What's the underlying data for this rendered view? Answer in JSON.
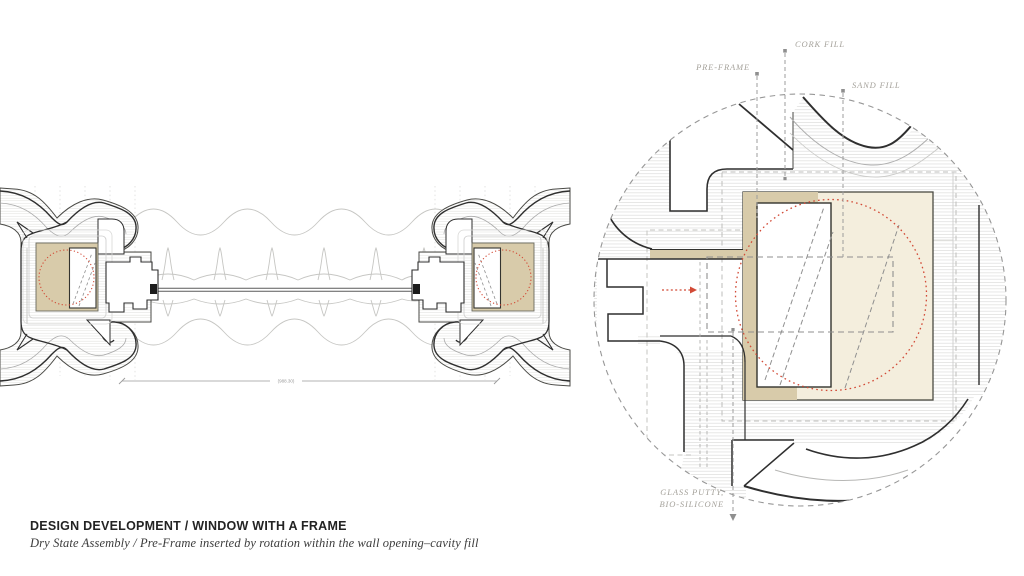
{
  "header": {
    "title": "DESIGN DEVELOPMENT / WINDOW WITH A FRAME",
    "subtitle": "Dry State Assembly /  Pre-Frame inserted by rotation within the wall opening–cavity fill"
  },
  "detail_labels": {
    "cork": "CORK FILL",
    "preframe": "PRE-FRAME",
    "sand": "SAND FILL",
    "glass_line1": "GLASS PUTTY,",
    "glass_line2": "BIO-SILICONE"
  },
  "plan": {
    "dimension": "(988.30)"
  },
  "colors": {
    "accent_red": "#d24a36",
    "cavity_sand_fill": "#f4eedd",
    "cork_fill_tan": "#d8cbaa",
    "line_dark": "#2f2f2f",
    "annotation_gray": "#a5a29b",
    "hatch_gray": "#dadad7"
  }
}
